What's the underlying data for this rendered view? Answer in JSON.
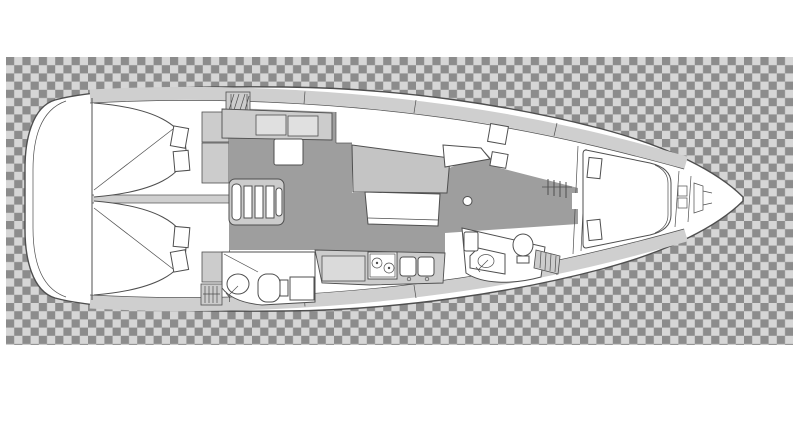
{
  "image": {
    "description": "Top-view interior layout plan of a sailing yacht (bow pointing right) rendered over a gray transparency checkerboard",
    "kind": "yacht-deck-plan"
  },
  "canvas": {
    "width": 800,
    "height": 446,
    "background": "#ffffff"
  },
  "checkerboard": {
    "x": 6,
    "y": 57,
    "width": 787,
    "height": 288,
    "cell": 8.2,
    "dark": "#8c8c8c",
    "light": "#d6d6d6"
  },
  "palette": {
    "hull": "#ffffff",
    "outline": "#4f4f4f",
    "deck_band": "#cfcfcf",
    "floor": "#9e9e9e",
    "furniture": "#cccccc",
    "cabinet_door": "#e0e0e0",
    "module": "#dadada",
    "table": "#c4c4c4",
    "white": "#ffffff"
  },
  "regions": {
    "stern_platform": "stern swim platform",
    "aft_cabin_top": "aft double cabin (port)",
    "aft_cabin_bottom": "aft double cabin (starboard)",
    "companionway": "companionway steps",
    "aft_head": "aft head with toilet and sink",
    "galley": "galley with stove and double sink",
    "saloon": "saloon with U-settee and table",
    "forward_head": "forward head with toilet and sink",
    "wardrobe": "hanging wardrobe",
    "forward_cabin": "forward V-berth cabin",
    "anchor_locker": "anchor locker",
    "bow": "bow tip"
  }
}
